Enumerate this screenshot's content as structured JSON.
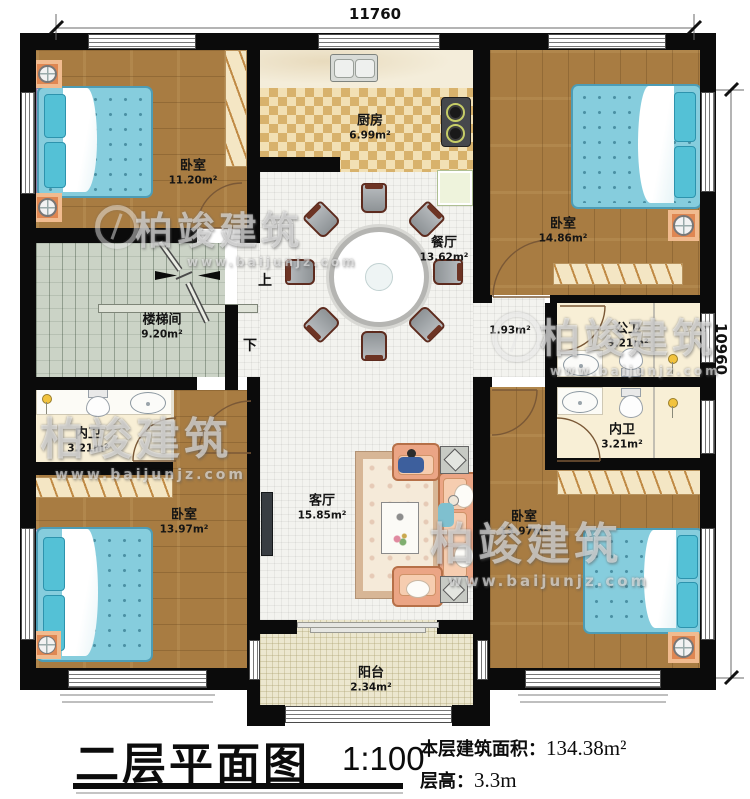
{
  "plan": {
    "dim_top": "11760",
    "dim_right": "10960",
    "stairs": {
      "name": "楼梯间",
      "area": "9.20m²",
      "up": "上",
      "down": "下"
    },
    "rooms": {
      "bedroom_tl": {
        "name": "卧室",
        "area": "11.20m²"
      },
      "kitchen": {
        "name": "厨房",
        "area": "6.99m²"
      },
      "bedroom_tr": {
        "name": "卧室",
        "area": "14.86m²"
      },
      "dining": {
        "name": "餐厅",
        "area": "13.62m²"
      },
      "corridor": {
        "area": "1.93m²"
      },
      "public_bath": {
        "name": "公卫",
        "area": "3.21m²"
      },
      "bath_left": {
        "name": "内卫",
        "area": "3.21m²"
      },
      "bath_right": {
        "name": "内卫",
        "area": "3.21m²"
      },
      "bedroom_bl": {
        "name": "卧室",
        "area": "13.97m²"
      },
      "living": {
        "name": "客厅",
        "area": "15.85m²"
      },
      "bedroom_br": {
        "name": "卧室",
        "area": "13.97m²"
      },
      "balcony": {
        "name": "阳台",
        "area": "2.34m²"
      }
    }
  },
  "watermark": {
    "brand": "柏竣建筑",
    "url": "www.baijunjz.com"
  },
  "title_block": {
    "plan_name": "二层平面图",
    "scale": "1:100",
    "area_label": "本层建筑面积：",
    "area_value": "134.38m²",
    "floor_height_label": "层高：",
    "floor_height_value": "3.3m"
  },
  "colors": {
    "wall": "#0b0b0b",
    "wood": "#a87c42",
    "bed": "#86cddd",
    "stair": "#cbd3c6",
    "accent_orange": "#df8752"
  }
}
